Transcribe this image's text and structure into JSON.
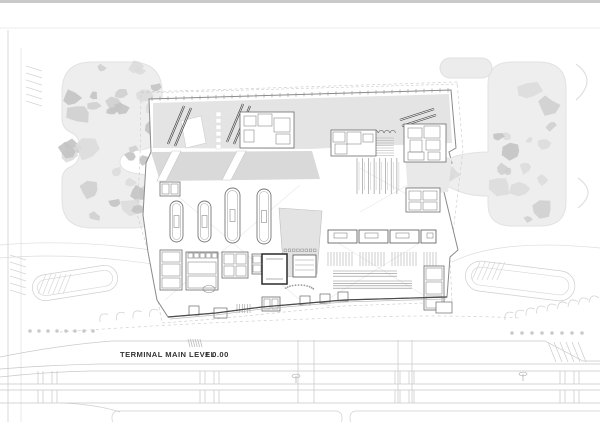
{
  "title": {
    "label": "TERMINAL MAIN LEVEL",
    "elevation": "± 0.00"
  },
  "colors": {
    "bg": "#ffffff",
    "topbar": "#c9c9c9",
    "hairline": "#e6e6e6",
    "landscape": "#eeeeee",
    "landscape_stroke": "#e2e2e2",
    "canopyA": "#dcdcdc",
    "canopyB": "#cfcfcf",
    "canopyC": "#c3c3c3",
    "apron": "#e4e4e4",
    "plaza": "#d9d9d9",
    "notch": "#e9e9e9",
    "garden": "#e3e3e3",
    "road": "#c9c9c9",
    "road_faint": "#dedede",
    "outline": "#8a8a8a",
    "detail": "#6b6b6b",
    "detail_dark": "#3a3a3a",
    "mid": "#9c9c9c",
    "construction": "#e7e7e7",
    "text": "#333333"
  },
  "legend": {
    "building_name": "terminal-building",
    "level_note": "main level plan at elevation zero"
  },
  "canopy_regions": [
    {
      "name": "left-grove-upper",
      "x": 66,
      "y": 66,
      "w": 92,
      "h": 72,
      "count": 15,
      "seed": 11
    },
    {
      "name": "left-grove-lower",
      "x": 66,
      "y": 142,
      "w": 92,
      "h": 82,
      "count": 16,
      "seed": 23
    },
    {
      "name": "right-grove",
      "x": 492,
      "y": 72,
      "w": 70,
      "h": 148,
      "count": 16,
      "seed": 37
    },
    {
      "name": "east-notch-grove",
      "x": 408,
      "y": 154,
      "w": 44,
      "h": 34,
      "count": 7,
      "seed": 51
    },
    {
      "name": "plaza-grove",
      "x": 156,
      "y": 153,
      "w": 156,
      "h": 24,
      "count": 9,
      "seed": 63
    },
    {
      "name": "central-garden-grove",
      "x": 282,
      "y": 212,
      "w": 36,
      "h": 58,
      "count": 8,
      "seed": 77
    }
  ],
  "jet_bridges": [
    {
      "x1": 184,
      "y1": 106,
      "x2": 168,
      "y2": 144
    },
    {
      "x1": 191,
      "y1": 108,
      "x2": 175,
      "y2": 146
    },
    {
      "x1": 243,
      "y1": 104,
      "x2": 227,
      "y2": 142
    },
    {
      "x1": 250,
      "y1": 106,
      "x2": 234,
      "y2": 144
    },
    {
      "x1": 434,
      "y1": 109,
      "x2": 400,
      "y2": 120
    },
    {
      "x1": 436,
      "y1": 115,
      "x2": 402,
      "y2": 126
    }
  ],
  "stand_squares": {
    "x": 216,
    "y": 112,
    "step": 6.5,
    "count": 6,
    "w": 5,
    "h": 4.5
  },
  "carousels": [
    {
      "x": 170,
      "y": 201,
      "w": 13,
      "h": 41
    },
    {
      "x": 198,
      "y": 201,
      "w": 13,
      "h": 41
    },
    {
      "x": 225,
      "y": 188,
      "w": 15,
      "h": 55
    },
    {
      "x": 257,
      "y": 189,
      "w": 14,
      "h": 55
    }
  ],
  "checkin_islands": [
    {
      "x": 328,
      "y": 230,
      "w": 29,
      "h": 13
    },
    {
      "x": 359,
      "y": 230,
      "w": 29,
      "h": 13
    },
    {
      "x": 390,
      "y": 230,
      "w": 29,
      "h": 13
    },
    {
      "x": 421,
      "y": 230,
      "w": 15,
      "h": 13
    }
  ],
  "queue_combs": [
    {
      "x": 328,
      "y": 252,
      "w": 26,
      "h": 14
    },
    {
      "x": 360,
      "y": 252,
      "w": 26,
      "h": 14
    },
    {
      "x": 392,
      "y": 252,
      "w": 26,
      "h": 14
    },
    {
      "x": 424,
      "y": 252,
      "w": 12,
      "h": 14
    }
  ],
  "conveyor_bundles": [
    {
      "x": 333,
      "y": 271,
      "w": 64,
      "lines": 3,
      "gap": 2.6
    },
    {
      "x": 333,
      "y": 281,
      "w": 79,
      "lines": 4,
      "gap": 2.4
    }
  ],
  "security_lanes": {
    "x": 357,
    "step": 5.7,
    "count": 8,
    "y1": 158,
    "y2": 194
  },
  "arrival_arcs": {
    "x": 358,
    "step": 5.8,
    "count": 7,
    "y": 133,
    "r": 2.6
  },
  "queue_block": {
    "x": 358,
    "y": 138,
    "w": 36,
    "lines": 8,
    "gap": 2.5
  },
  "room_clusters": [
    {
      "name": "pier-rooms-mid",
      "outer": [
        240,
        112,
        54,
        36
      ],
      "rooms": [
        [
          244,
          116,
          12,
          10
        ],
        [
          258,
          114,
          14,
          12
        ],
        [
          274,
          118,
          16,
          14
        ],
        [
          244,
          130,
          10,
          12
        ],
        [
          276,
          134,
          14,
          10
        ]
      ]
    },
    {
      "name": "concourse-rooms-west",
      "outer": [
        331,
        130,
        45,
        26
      ],
      "rooms": [
        [
          333,
          132,
          12,
          10
        ],
        [
          347,
          132,
          14,
          12
        ],
        [
          363,
          134,
          10,
          8
        ],
        [
          335,
          144,
          12,
          10
        ]
      ]
    },
    {
      "name": "concourse-rooms-east",
      "outer": [
        404,
        124,
        42,
        38
      ],
      "rooms": [
        [
          408,
          128,
          14,
          10
        ],
        [
          424,
          126,
          16,
          12
        ],
        [
          410,
          140,
          12,
          12
        ],
        [
          426,
          140,
          14,
          10
        ],
        [
          408,
          152,
          16,
          8
        ],
        [
          428,
          152,
          12,
          8
        ]
      ]
    },
    {
      "name": "east-wing-rooms",
      "outer": [
        406,
        188,
        34,
        24
      ],
      "rooms": [
        [
          409,
          191,
          12,
          9
        ],
        [
          423,
          191,
          14,
          9
        ],
        [
          409,
          202,
          12,
          8
        ],
        [
          423,
          202,
          14,
          8
        ]
      ]
    },
    {
      "name": "southeast-rooms",
      "outer": [
        424,
        266,
        20,
        44
      ],
      "rooms": [
        [
          426,
          268,
          16,
          12
        ],
        [
          426,
          282,
          16,
          12
        ],
        [
          426,
          296,
          16,
          12
        ]
      ]
    },
    {
      "name": "west-hall-rooms",
      "outer": [
        160,
        182,
        20,
        14
      ],
      "rooms": [
        [
          162,
          184,
          7,
          10
        ],
        [
          171,
          184,
          7,
          10
        ]
      ]
    },
    {
      "name": "south-rooms-a",
      "outer": [
        160,
        250,
        22,
        40
      ],
      "rooms": [
        [
          162,
          252,
          18,
          10
        ],
        [
          162,
          264,
          18,
          12
        ],
        [
          162,
          278,
          18,
          10
        ]
      ]
    },
    {
      "name": "south-rooms-b",
      "outer": [
        186,
        252,
        32,
        38
      ],
      "rooms": [
        [
          188,
          262,
          28,
          12
        ],
        [
          188,
          276,
          28,
          12
        ]
      ]
    },
    {
      "name": "south-rooms-c",
      "outer": [
        222,
        252,
        26,
        26
      ],
      "rooms": [
        [
          224,
          254,
          10,
          10
        ],
        [
          236,
          254,
          10,
          10
        ],
        [
          224,
          266,
          10,
          10
        ],
        [
          236,
          266,
          10,
          10
        ]
      ]
    },
    {
      "name": "south-rooms-d",
      "outer": [
        252,
        254,
        10,
        20
      ],
      "rooms": [
        [
          253,
          256,
          8,
          7
        ],
        [
          253,
          265,
          8,
          7
        ]
      ]
    },
    {
      "name": "facade-kiosks",
      "outer": [
        262,
        297,
        18,
        14
      ],
      "rooms": [
        [
          264,
          299,
          6,
          10
        ],
        [
          272,
          299,
          6,
          10
        ]
      ]
    }
  ],
  "square_row_b": {
    "x": 188,
    "y": 253,
    "step": 6,
    "count": 5,
    "size": 5
  },
  "garden_square_row": {
    "x": 284,
    "y": 249,
    "step": 4.2,
    "count": 8,
    "size": 2.6
  },
  "core_void": {
    "x": 262,
    "y": 254,
    "w": 25,
    "h": 30
  },
  "amphitheater": {
    "x": 293,
    "y": 255,
    "w": 23,
    "h": 22
  },
  "facade_boxes": [
    [
      300,
      296,
      10,
      9
    ],
    [
      320,
      294,
      10,
      9
    ],
    [
      338,
      292,
      10,
      9
    ],
    [
      189,
      306,
      10,
      9
    ],
    [
      214,
      308,
      13,
      10
    ],
    [
      436,
      302,
      16,
      11
    ]
  ],
  "facade_comb": {
    "x": 237,
    "y": 304,
    "w": 14,
    "h": 9,
    "step": 2.6
  },
  "band_ticks": [
    38,
    52,
    200,
    214,
    395,
    409,
    560,
    574
  ],
  "road_connectors": [
    [
      298,
      340,
      298,
      403
    ],
    [
      314,
      340,
      314,
      403
    ],
    [
      398,
      340,
      398,
      403
    ],
    [
      412,
      340,
      412,
      403
    ]
  ],
  "lamp_posts": [
    [
      296,
      376
    ],
    [
      523,
      374
    ]
  ],
  "tree_dot_rows": [
    {
      "x": 30,
      "y": 331,
      "step": 9,
      "count": 8
    },
    {
      "x": 512,
      "y": 333,
      "step": 10,
      "count": 8
    }
  ],
  "parking_fans": [
    {
      "name": "southwest-parking",
      "cx": 100,
      "cy": 322,
      "count": 13,
      "dx": 16.5,
      "dy": -1.7,
      "rot": -38
    },
    {
      "name": "southeast-parking",
      "cx": 505,
      "cy": 320,
      "count": 9,
      "dx": 10.5,
      "dy": -2.2,
      "rot": -35
    }
  ],
  "construction_crosses": [
    [
      165,
      185,
      300,
      300
    ],
    [
      300,
      185,
      165,
      300
    ],
    [
      330,
      238,
      428,
      298
    ],
    [
      428,
      238,
      330,
      298
    ],
    [
      360,
      168,
      438,
      212
    ],
    [
      438,
      168,
      360,
      212
    ],
    [
      160,
      102,
      250,
      146
    ],
    [
      250,
      102,
      160,
      146
    ]
  ]
}
